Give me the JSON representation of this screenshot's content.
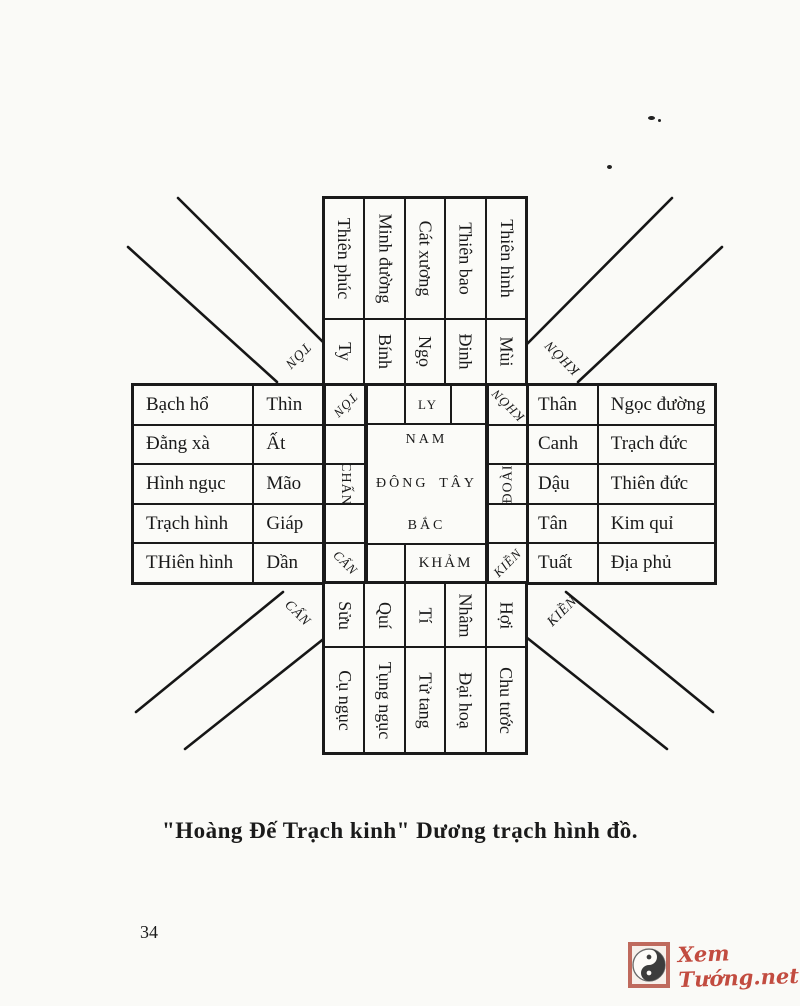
{
  "caption": "\"Hoàng Đế Trạch kinh\" Dương trạch hình đồ.",
  "page_number": "34",
  "diagram": {
    "top": {
      "names": [
        "Thiên phúc",
        "Minh đường",
        "Cát xương",
        "Thiên bao",
        "Thiên hình"
      ],
      "branches": [
        "Ty",
        "Bính",
        "Ngọ",
        "Đinh",
        "Mùi"
      ]
    },
    "left": {
      "spirits": [
        "Bạch hổ",
        "Đằng xà",
        "Hình ngục",
        "Trạch hình",
        "THiên hình"
      ],
      "branches": [
        "Thìn",
        "Ất",
        "Mão",
        "Giáp",
        "Dần"
      ]
    },
    "right": {
      "branches": [
        "Thân",
        "Canh",
        "Dậu",
        "Tân",
        "Tuất"
      ],
      "spirits": [
        "Ngọc đường",
        "Trạch đức",
        "Thiên đức",
        "Kim quỉ",
        "Địa phủ"
      ]
    },
    "bottom": {
      "branches": [
        "Sửu",
        "Quí",
        "Tí",
        "Nhâm",
        "Hợi"
      ],
      "names": [
        "Cụ ngục",
        "Tụng ngục",
        "Tử tang",
        "Đại hoạ",
        "Chu tước"
      ]
    },
    "center": {
      "ly": "LY",
      "nam": "NAM",
      "dong": "ĐÔNG",
      "tay": "TÂY",
      "bac": "BẮC",
      "kham": "KHẢM"
    },
    "inner_labels": {
      "ton": "TỐN",
      "khon": "KHÔN",
      "chan": "CHẤN",
      "doai": "ĐOÀI",
      "can": "CẤN",
      "kien": "KIỀN"
    },
    "outer_labels": {
      "ton": "TÔN",
      "khon": "KHÔN",
      "can": "CẤN",
      "kien": "KIỀN"
    }
  },
  "watermark": {
    "site": "Xem Tướng.net",
    "color": "#c24c40",
    "icon": "yin-yang-icon"
  }
}
